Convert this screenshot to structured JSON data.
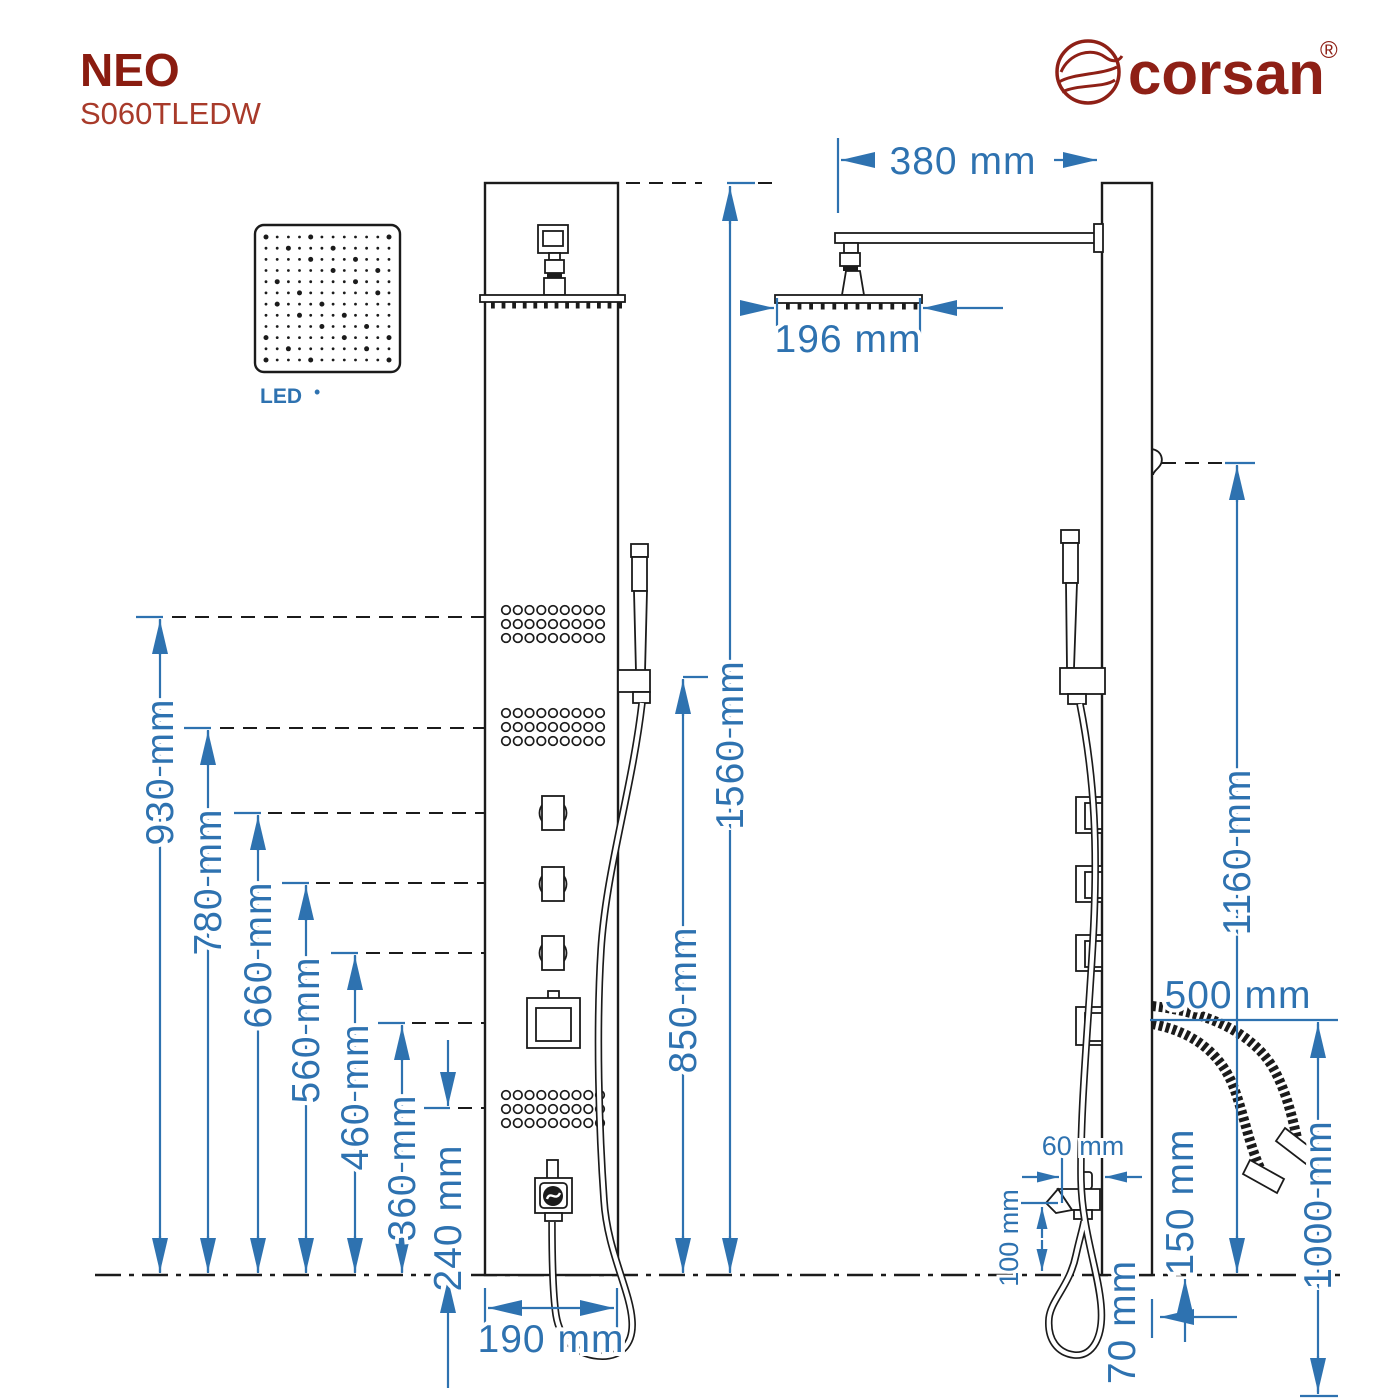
{
  "brand": {
    "logo_text": "corsan",
    "registered_mark": "®"
  },
  "product": {
    "series": "NEO",
    "model": "S060TLEDW"
  },
  "led": {
    "label": "LED",
    "bullet": "•"
  },
  "dimensions": {
    "front": {
      "panel_height": "1560 mm",
      "jets_top": "930 mm",
      "hand_shower": "850 mm",
      "jets_middle": "780 mm",
      "knob1": "660 mm",
      "knob2": "560 mm",
      "knob3": "460 mm",
      "display": "360 mm",
      "jets_bottom": "240 mm",
      "panel_width": "190 mm"
    },
    "side": {
      "arm_length": "380 mm",
      "head_depth": "196 mm",
      "hook_height": "1160 mm",
      "connections_height": "500 mm",
      "spout_depth": "60 mm",
      "spout_height": "100 mm",
      "height_150": "150 mm",
      "hose_70": "70 mm",
      "supply_hoses": "1000 mm"
    }
  },
  "features": {
    "led_matrix": {
      "rows": 12,
      "cols": 12
    },
    "jet_grid": {
      "rows": 3,
      "cols": 9
    },
    "front_nozzles": 13,
    "side_nozzles": 12
  },
  "colors": {
    "dimension_blue": "#2e72b0",
    "line_black": "#1b1b1b",
    "brand_red": "#8e2016",
    "title_red": "#8a1c10",
    "model_red": "#a83a2a"
  }
}
